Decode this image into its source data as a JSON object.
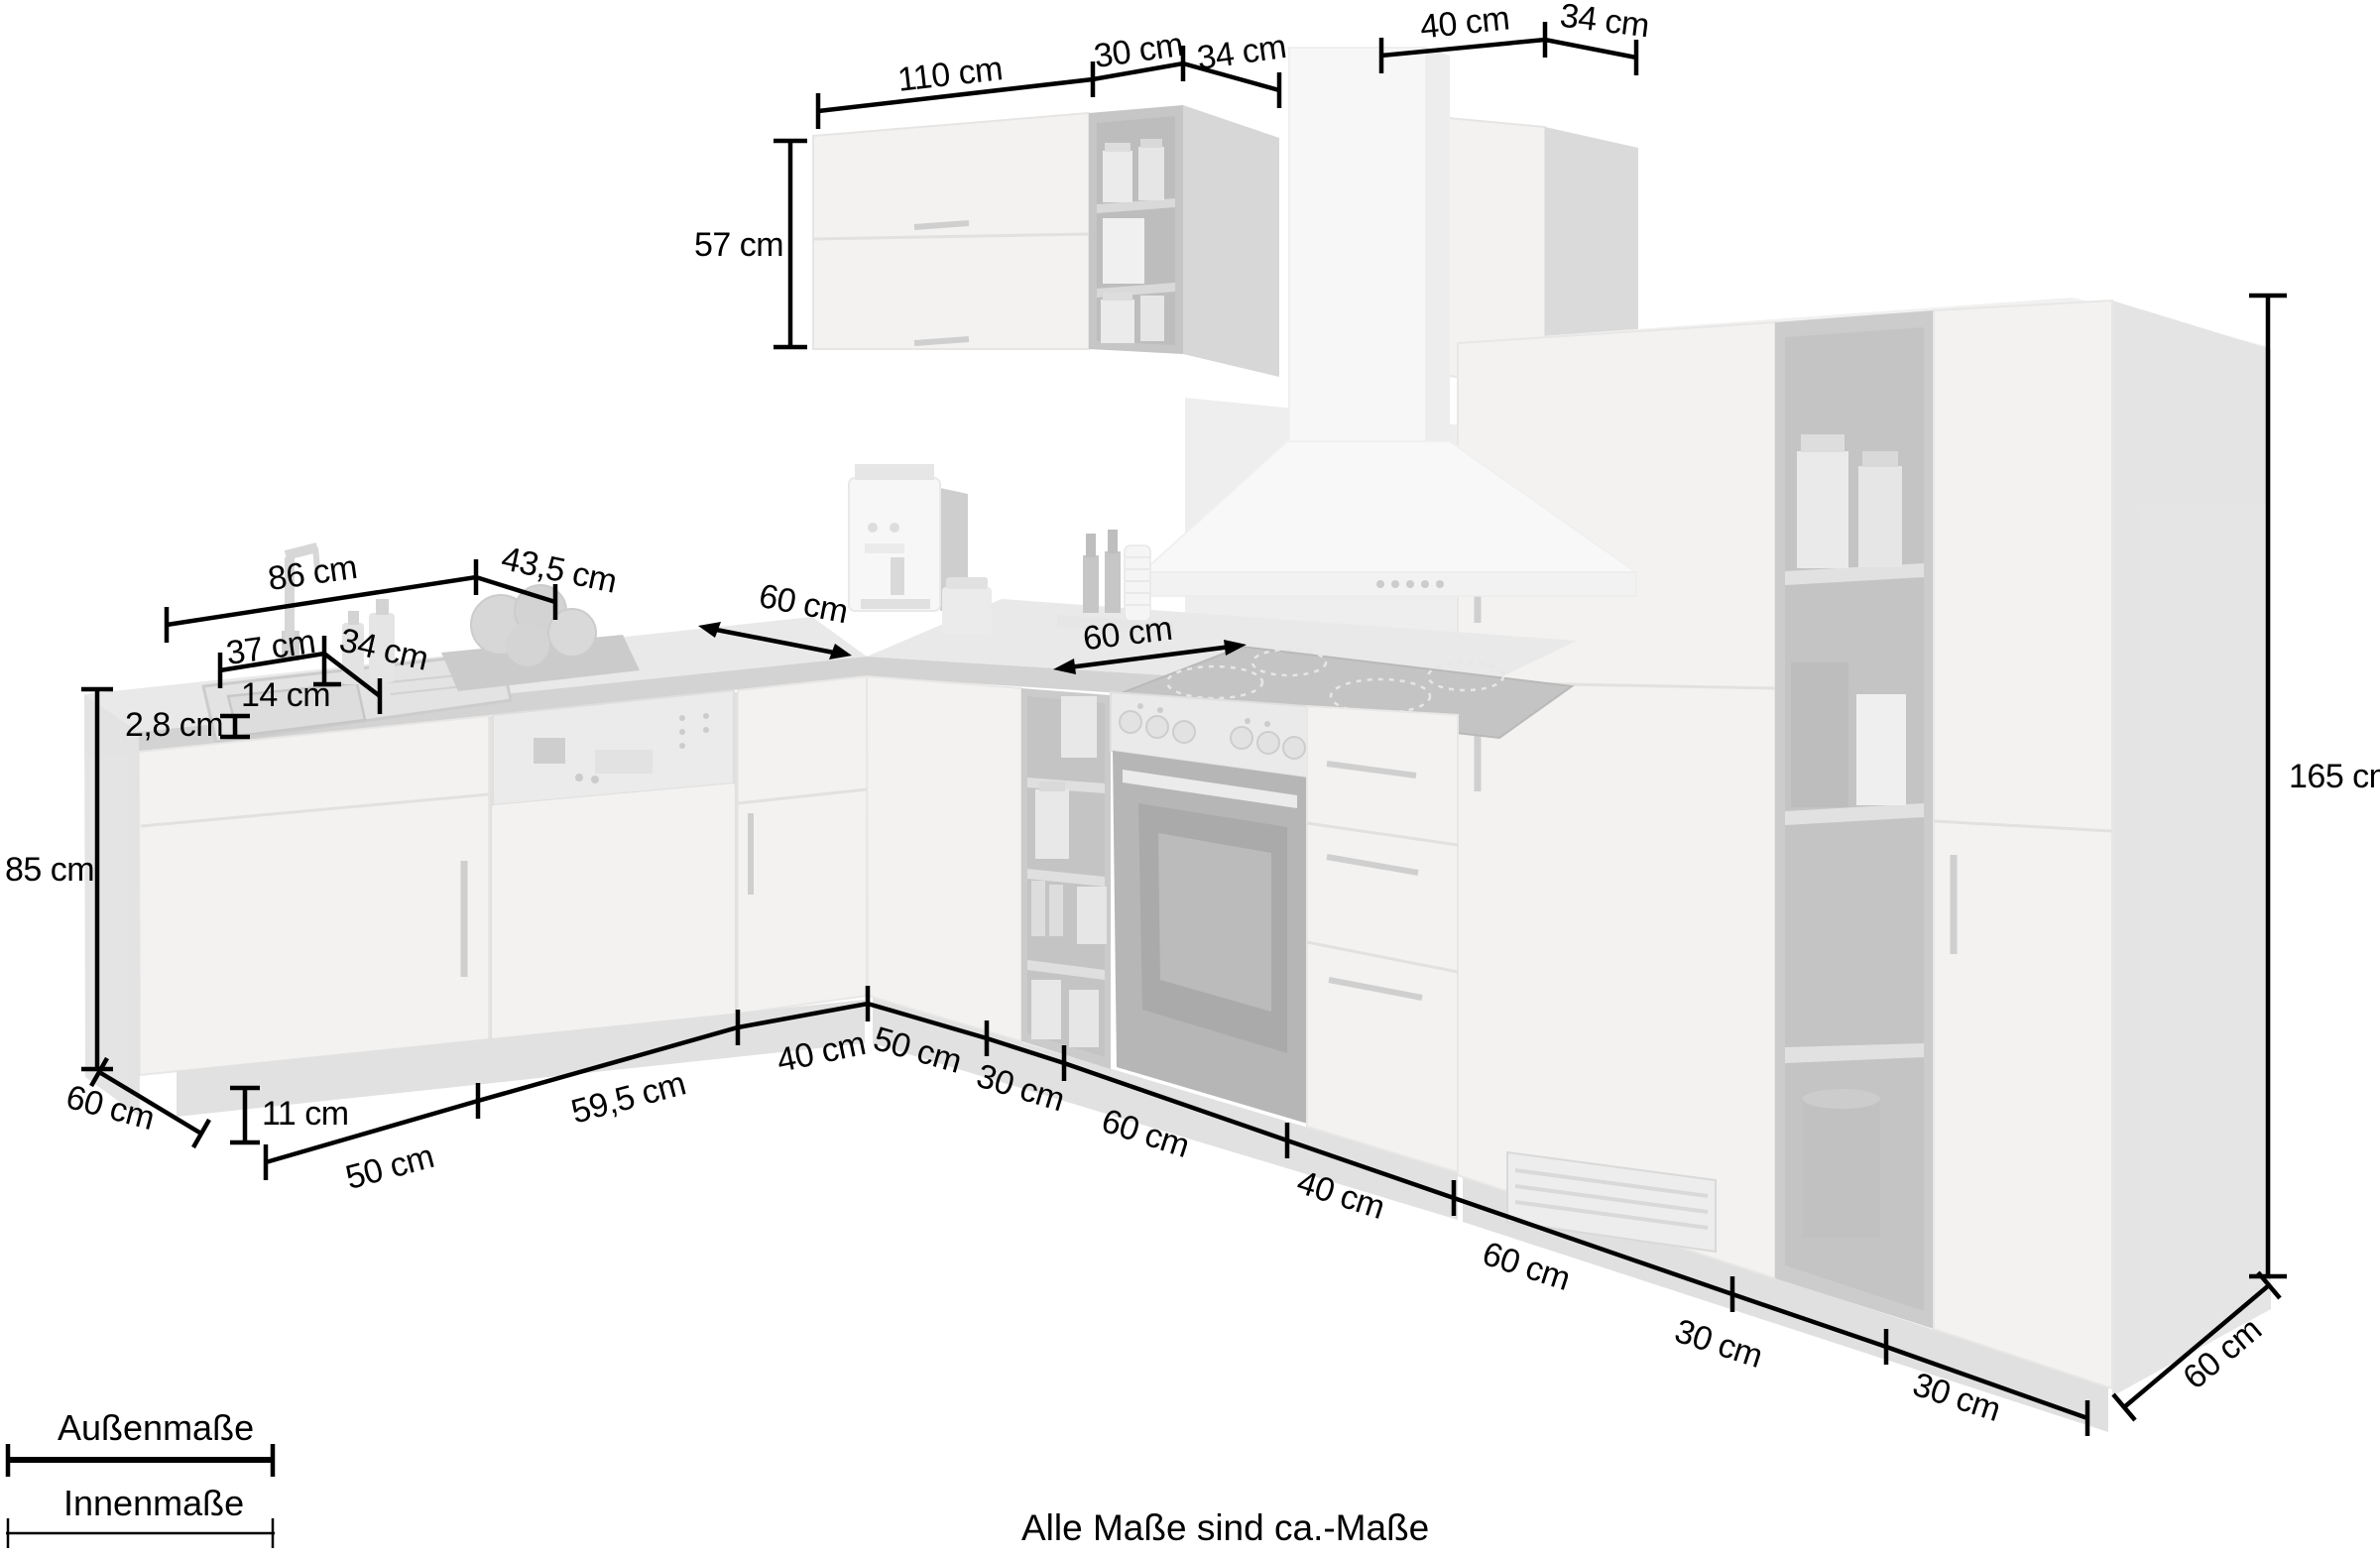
{
  "note": "Alle Maße sind ca.-Maße",
  "legend": {
    "outer_label": "Außenmaße",
    "inner_label": "Innenmaße"
  },
  "colors": {
    "dimension_line": "#000000",
    "render_wood": "#e9e7e4",
    "render_dark_panel": "#b0b0b0",
    "render_worktop_edge": "#a8a8a8",
    "background": "#ffffff"
  },
  "dims": {
    "wall_110": "110 cm",
    "wall_30": "30 cm",
    "wall_34": "34 cm",
    "wall_right_40": "40 cm",
    "wall_right_34": "34 cm",
    "wall_height_57": "57 cm",
    "worktop_86": "86 cm",
    "worktop_43_5": "43,5 cm",
    "sink_37": "37 cm",
    "sink_34": "34 cm",
    "sink_14": "14 cm",
    "worktop_thickness_2_8": "2,8 cm",
    "base_height_85": "85 cm",
    "depth_left_60": "60 cm",
    "plinth_11": "11 cm",
    "run_left_50": "50 cm",
    "run_left_59_5": "59,5 cm",
    "run_left_40": "40 cm",
    "run_right_50": "50 cm",
    "run_right_30": "30 cm",
    "run_right_60": "60 cm",
    "run_right_40": "40 cm",
    "run_right_60b": "60 cm",
    "run_right_30b": "30 cm",
    "run_right_30c": "30 cm",
    "depth_right_60": "60 cm",
    "tall_height_165": "165 cm",
    "worktop_depth_60_left": "60 cm",
    "worktop_depth_60_right": "60 cm"
  }
}
